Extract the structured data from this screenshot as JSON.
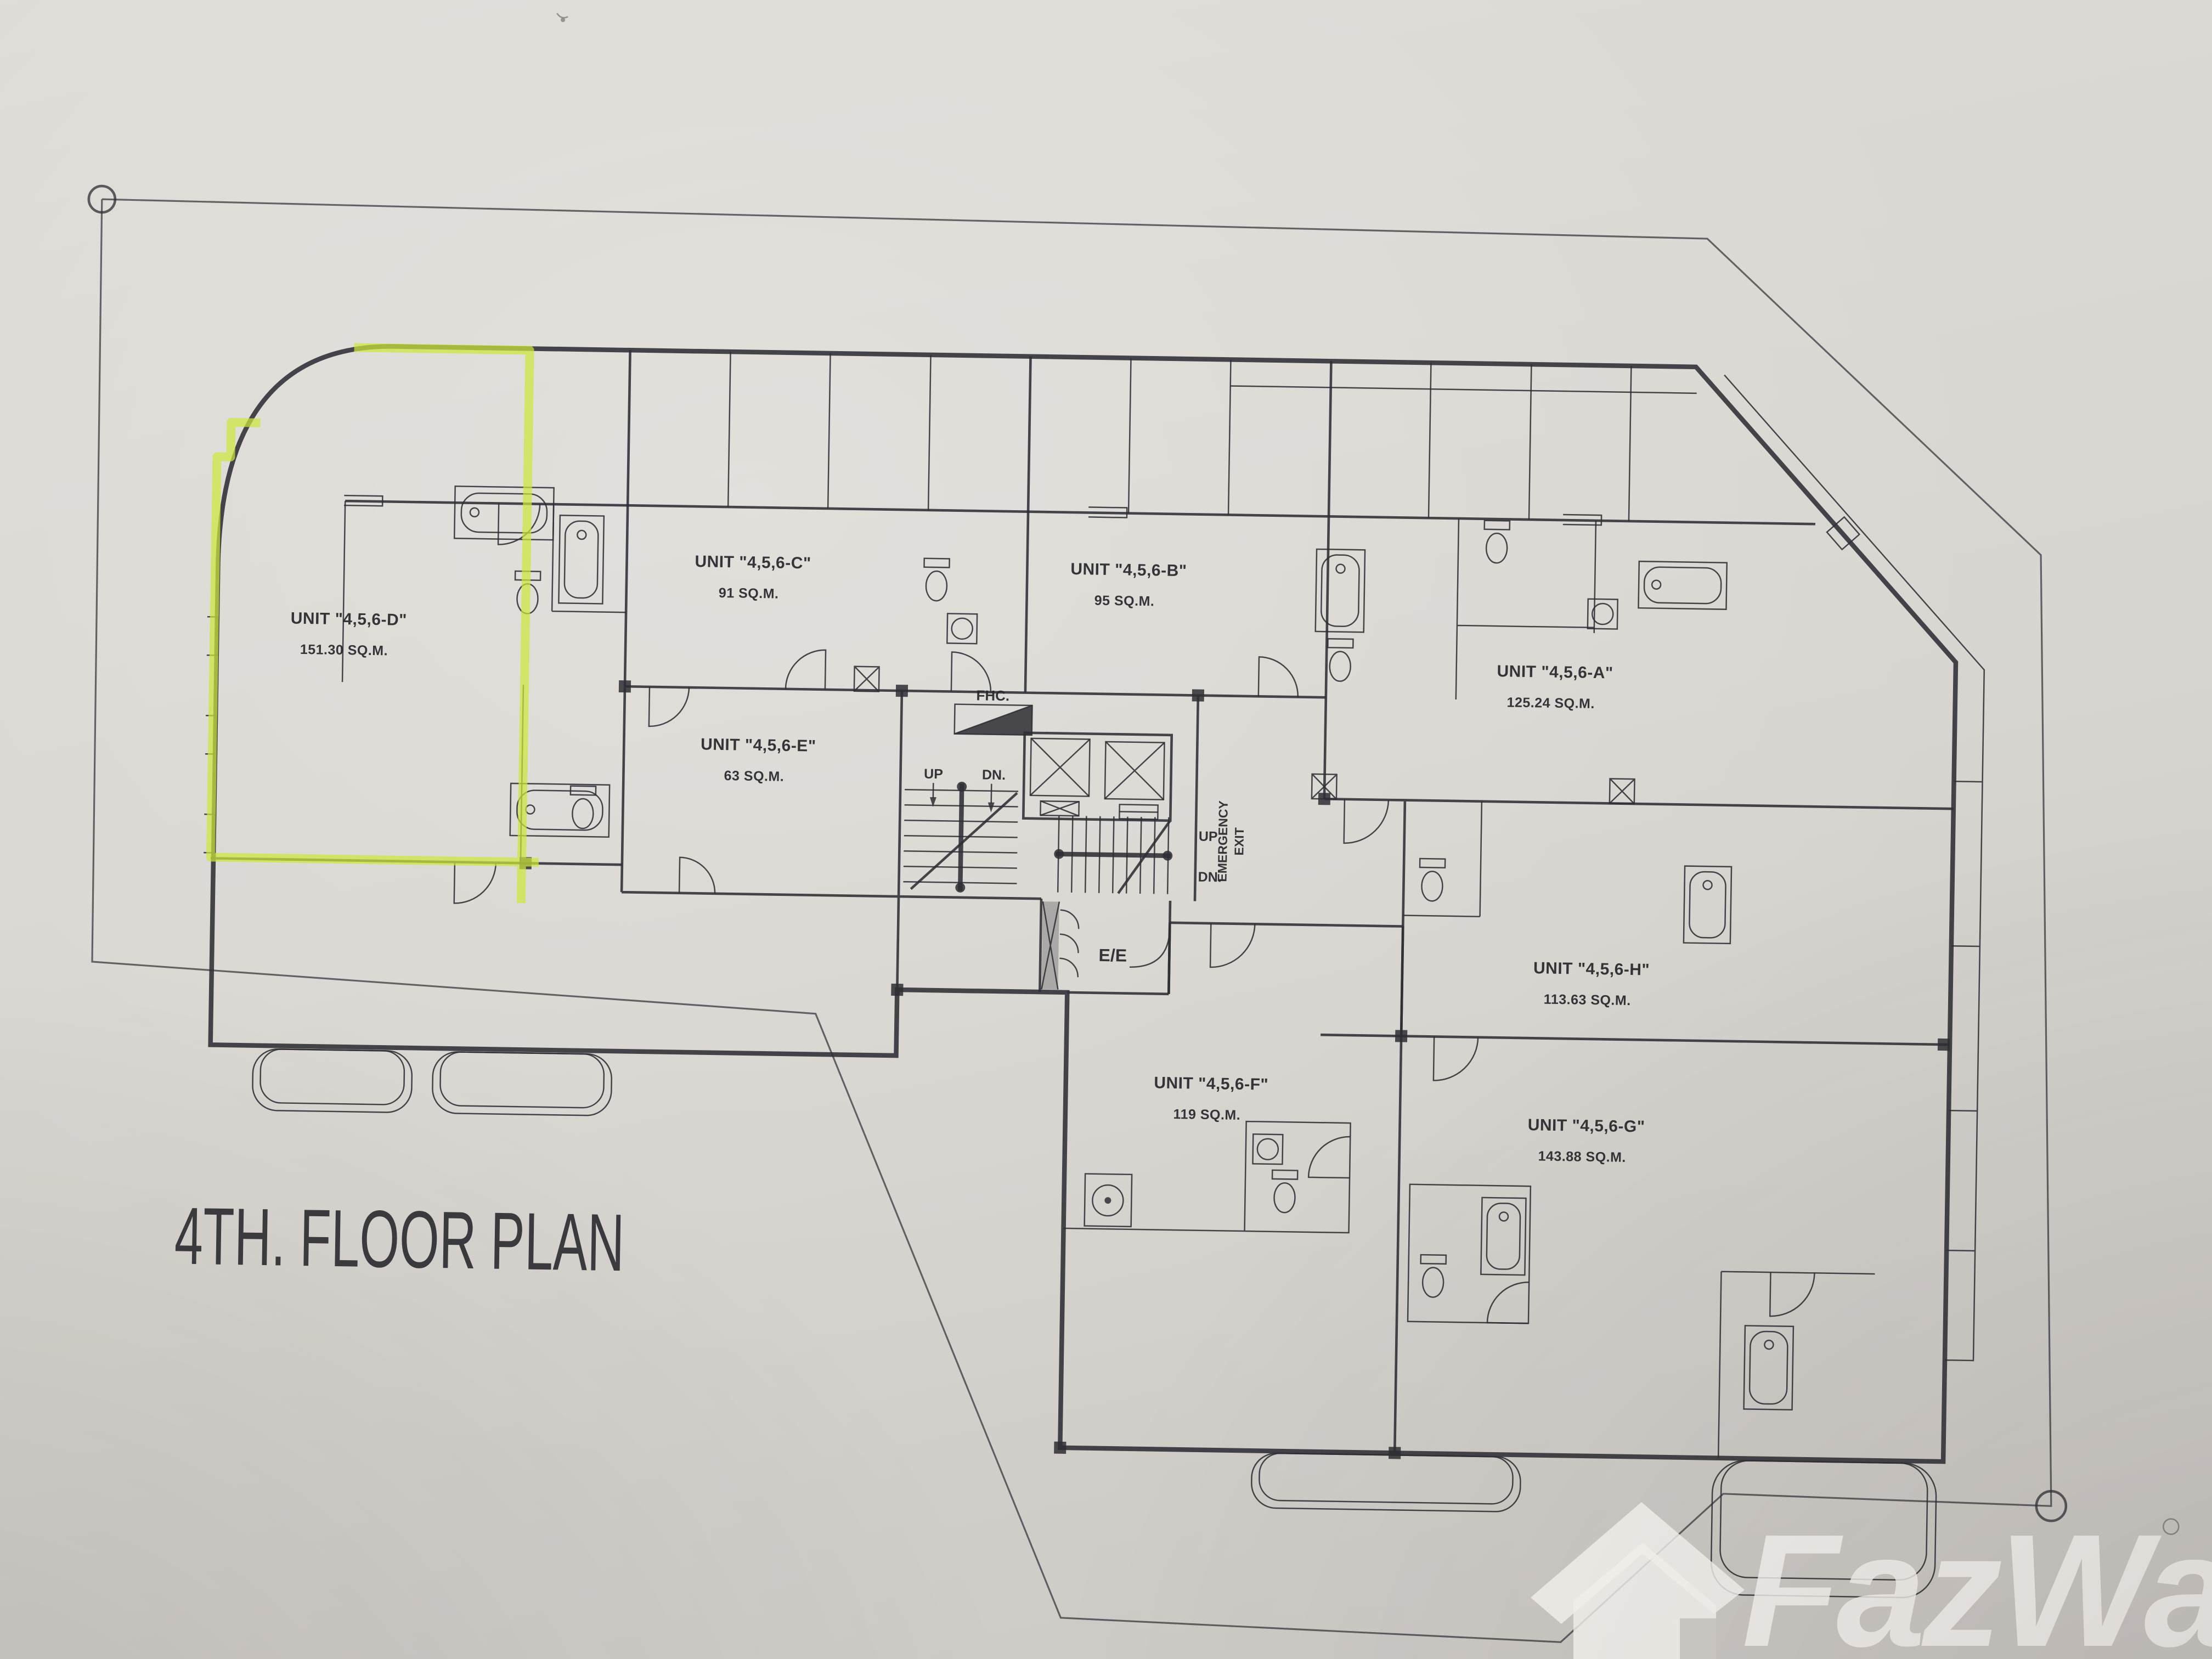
{
  "floor_plan": {
    "title": "4TH. FLOOR PLAN",
    "units": [
      {
        "id": "unit-d",
        "name": "UNIT \"4,5,6-D\"",
        "area": "151.30 SQ.M.",
        "highlighted": true
      },
      {
        "id": "unit-c",
        "name": "UNIT \"4,5,6-C\"",
        "area": "91 SQ.M.",
        "highlighted": false
      },
      {
        "id": "unit-b",
        "name": "UNIT \"4,5,6-B\"",
        "area": "95 SQ.M.",
        "highlighted": false
      },
      {
        "id": "unit-a",
        "name": "UNIT \"4,5,6-A\"",
        "area": "125.24 SQ.M.",
        "highlighted": false
      },
      {
        "id": "unit-e",
        "name": "UNIT \"4,5,6-E\"",
        "area": "63 SQ.M.",
        "highlighted": false
      },
      {
        "id": "unit-h",
        "name": "UNIT \"4,5,6-H\"",
        "area": "113.63 SQ.M.",
        "highlighted": false
      },
      {
        "id": "unit-f",
        "name": "UNIT \"4,5,6-F\"",
        "area": "119 SQ.M.",
        "highlighted": false
      },
      {
        "id": "unit-g",
        "name": "UNIT \"4,5,6-G\"",
        "area": "143.88 SQ.M.",
        "highlighted": false
      }
    ],
    "core": {
      "fhc": "FHC.",
      "up": "UP",
      "dn": "DN.",
      "emergency_line1": "EMERGENCY",
      "emergency_line2": "EXIT",
      "ee": "E/E"
    },
    "colors": {
      "highlight": "#cfe63b",
      "ink": "#2e2e34",
      "paper": "#d9d6d1"
    }
  },
  "watermark": {
    "brand": "FazWaz"
  }
}
